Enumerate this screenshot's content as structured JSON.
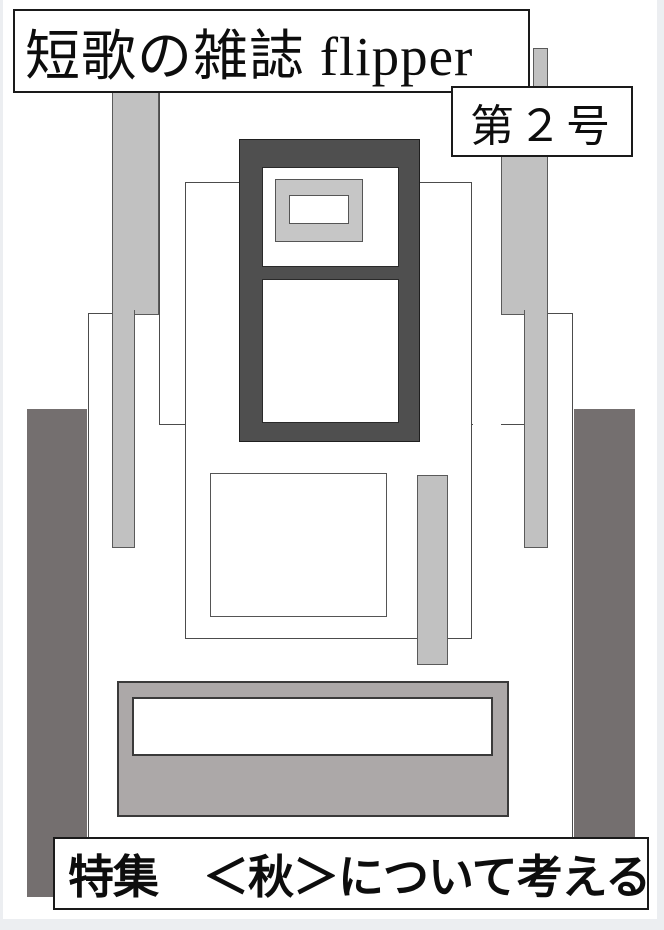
{
  "cover": {
    "title": "短歌の雑誌 flipper",
    "issue": "第２号",
    "feature": "特集　＜秋＞について考える"
  },
  "palette": {
    "page": "#FFFFFF",
    "canvas_bg": "#ECEEF1",
    "light_gray": "#C1C1C1",
    "medium_gray": "#ACA8A8",
    "warm_dark_gray": "#746F6F",
    "frame_dark": "#4F4F4F",
    "line": "#4C4C4C",
    "box_border": "#1A1A1A",
    "text": "#0D0D0D"
  }
}
